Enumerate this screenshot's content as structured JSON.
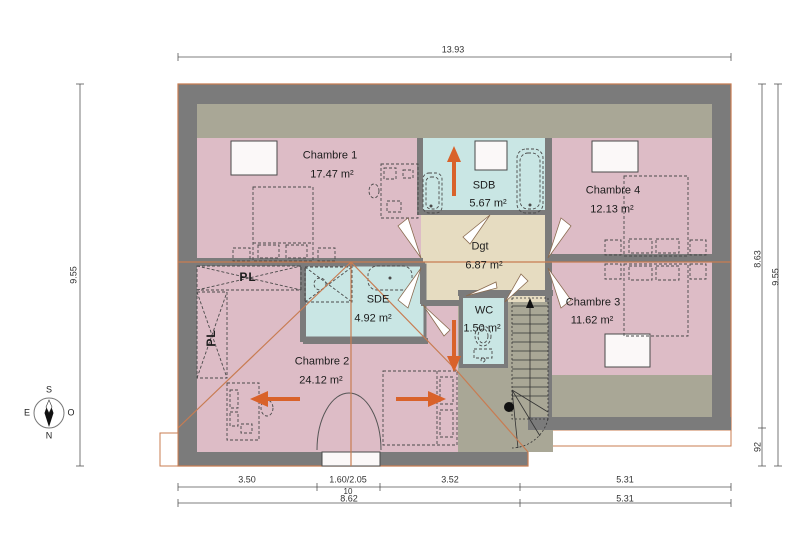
{
  "plan": {
    "rooms": [
      {
        "name": "Chambre 1",
        "area": "17.47 m²"
      },
      {
        "name": "SDB",
        "area": "5.67 m²"
      },
      {
        "name": "Chambre 4",
        "area": "12.13 m²"
      },
      {
        "name": "Dgt",
        "area": "6.87 m²"
      },
      {
        "name": "Chambre 3",
        "area": "11.62 m²"
      },
      {
        "name": "SDE",
        "area": "4.92 m²"
      },
      {
        "name": "WC",
        "area": "1.50 m²"
      },
      {
        "name": "Chambre 2",
        "area": "24.12 m²"
      }
    ],
    "closets": [
      {
        "label": "PL"
      },
      {
        "label": "PL"
      }
    ]
  },
  "dimensions": {
    "top_width": "13.93",
    "left_height": "9.55",
    "right_height_main": "8.63",
    "right_height_lower": "92",
    "right_height_total": "9.55",
    "bottom_segments": [
      "3.50",
      "1.60/2.05",
      "3.52",
      "5.31"
    ],
    "bottom_wall_thickness": "10",
    "bottom_totals": [
      "8.62",
      "5.31"
    ]
  },
  "compass": {
    "north": "N",
    "south": "S",
    "east": "E",
    "west": "O"
  },
  "colors": {
    "wall": "#7b7b7b",
    "bedroom_floor": "#ddbcc6",
    "bathroom_floor": "#c9e6e4",
    "hallway_floor": "#e6dcc1",
    "attic_floor": "#a9a796",
    "roof_outline": "#c87c52",
    "arrow": "#d9622a"
  }
}
